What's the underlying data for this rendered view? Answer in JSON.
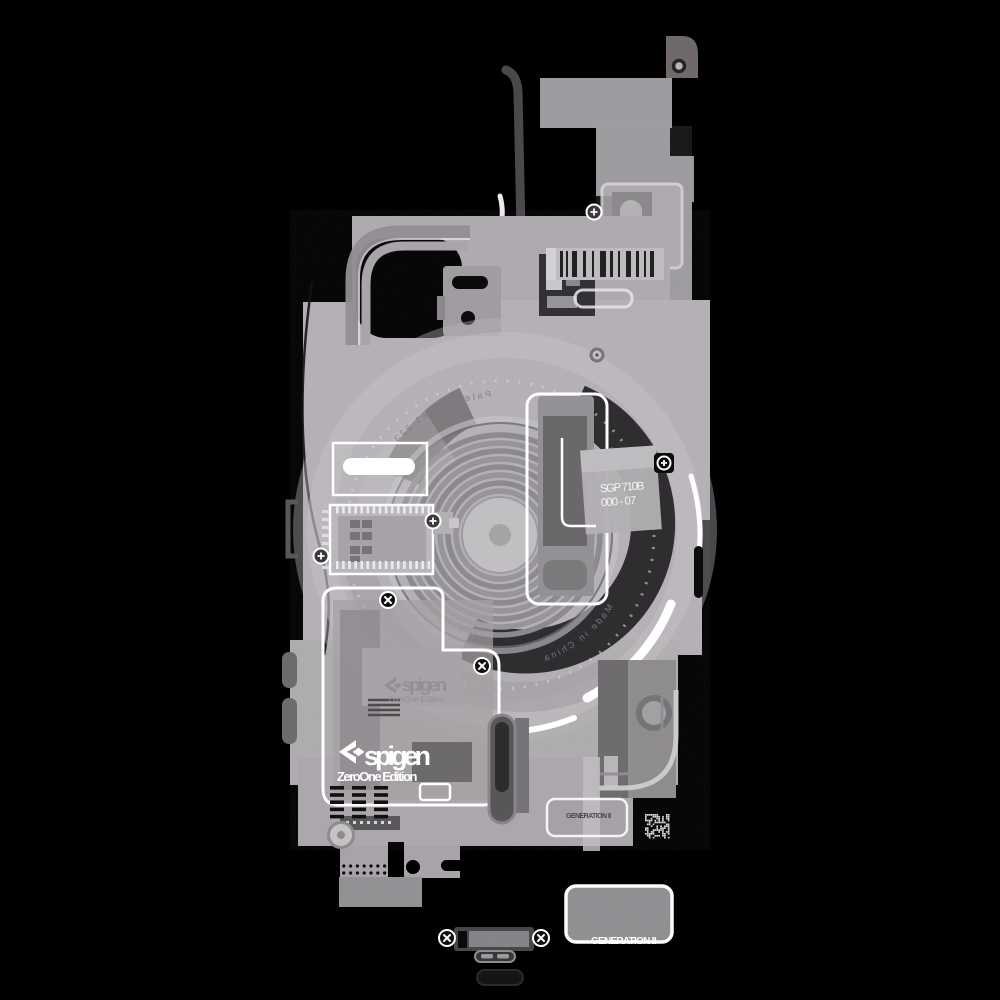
{
  "labels": {
    "model_code": "SGP 710B",
    "model_number": "000 - 07",
    "brand": "spigen",
    "edition": "ZeroOne Edition",
    "brand_watermark": "spigen",
    "edition_watermark": "ZeroOne Edition",
    "generation_tag": "GENERATION II",
    "generation_footer": "GENERATION II"
  },
  "ring_text": {
    "top": "Spigen",
    "patent": "Patent 1.863.223",
    "origin": "Made in China",
    "inner": "iPhone"
  },
  "palette": {
    "background": "#000000",
    "frame_gray": "#b3afb4",
    "panel_gray": "#9b989c",
    "shadow_gray": "#4c494d",
    "magnet_ring": "#2f2d30",
    "highlight_white": "#ffffff"
  }
}
